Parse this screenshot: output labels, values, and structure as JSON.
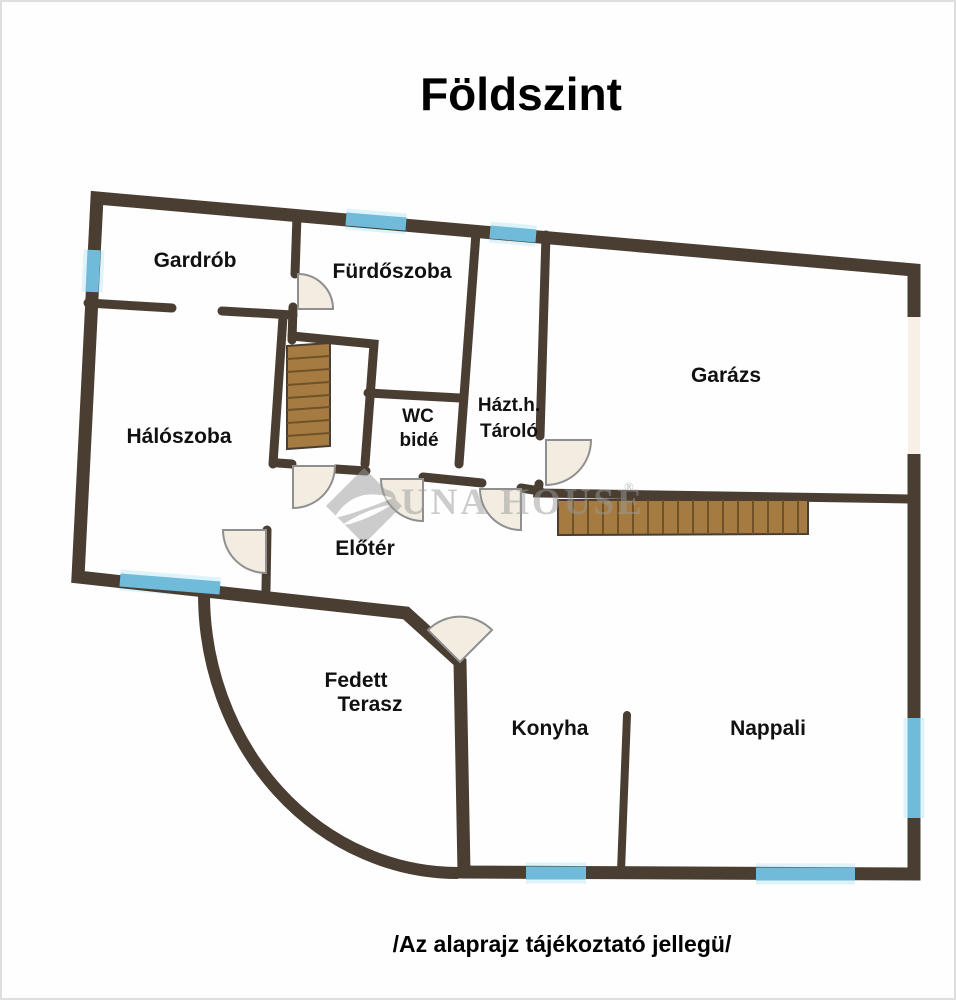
{
  "title": "Földszint",
  "disclaimer": "/Az alaprajz tájékoztató jellegü/",
  "watermark": {
    "brand": "DUNA HOUSE",
    "registered": "®"
  },
  "rooms": {
    "gardrob": {
      "name": "Gardrób"
    },
    "furdoszoba": {
      "name": "Fürdőszoba"
    },
    "haloszoba": {
      "name": "Hálószoba"
    },
    "wc": {
      "line1": "WC",
      "line2": "bidé"
    },
    "tarolo": {
      "line1": "Házt.h.",
      "line2": "Tároló"
    },
    "garazs": {
      "name": "Garázs"
    },
    "eloter": {
      "name": "Előtér"
    },
    "terasz": {
      "line1": "Fedett",
      "line2": "Terasz"
    },
    "konyha": {
      "name": "Konyha"
    },
    "nappali": {
      "name": "Nappali"
    }
  },
  "colors": {
    "wall": "#4a3e33",
    "window": "#6fbbd9",
    "window_glow": "#d9f1fa",
    "stairs": "#a57b42",
    "stair_line": "#6f5228",
    "door_fan": "#f3ece1",
    "fan_stroke": "#8f8f8f",
    "garage_door": "#f8efe7",
    "watermark": "#9b9b9b",
    "text": "#111111"
  }
}
